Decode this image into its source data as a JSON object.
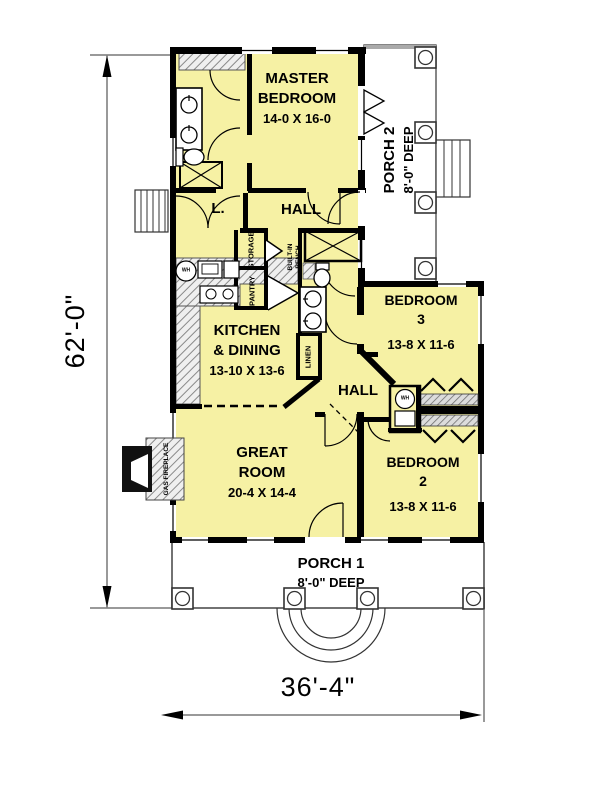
{
  "dimensions": {
    "height_label": "62'-0\"",
    "width_label": "36'-4\""
  },
  "rooms": {
    "master_bedroom": {
      "line1": "MASTER",
      "line2": "BEDROOM",
      "size": "14-0 X 16-0"
    },
    "porch2": {
      "line1": "PORCH 2",
      "line2": "8'-0\" DEEP"
    },
    "laundry": {
      "label": "L."
    },
    "hall_upper": {
      "label": "HALL"
    },
    "kitchen_dining": {
      "line1": "KITCHEN",
      "line2": "& DINING",
      "size": "13-10 X 13-6"
    },
    "bedroom3": {
      "line1": "BEDROOM",
      "line2": "3",
      "size": "13-8 X 11-6"
    },
    "hall_lower": {
      "label": "HALL"
    },
    "great_room": {
      "line1": "GREAT",
      "line2": "ROOM",
      "size": "20-4 X 14-4"
    },
    "bedroom2": {
      "line1": "BEDROOM",
      "line2": "2",
      "size": "13-8 X 11-6"
    },
    "porch1": {
      "line1": "PORCH 1",
      "line2": "8'-0\" DEEP"
    }
  },
  "fixtures": {
    "storage": "STORAGE",
    "pantry": "PANTRY",
    "built_in_bench_line1": "BUILT-IN",
    "built_in_bench_line2": "BENCH",
    "linen": "LINEN",
    "gas_fireplace": "GAS FIREPLACE",
    "washer": "WH",
    "water_heater": "WH"
  },
  "colors": {
    "floor_fill": "#F6F1A4",
    "wall": "#000000",
    "porch_fill": "#FFFFFF"
  }
}
